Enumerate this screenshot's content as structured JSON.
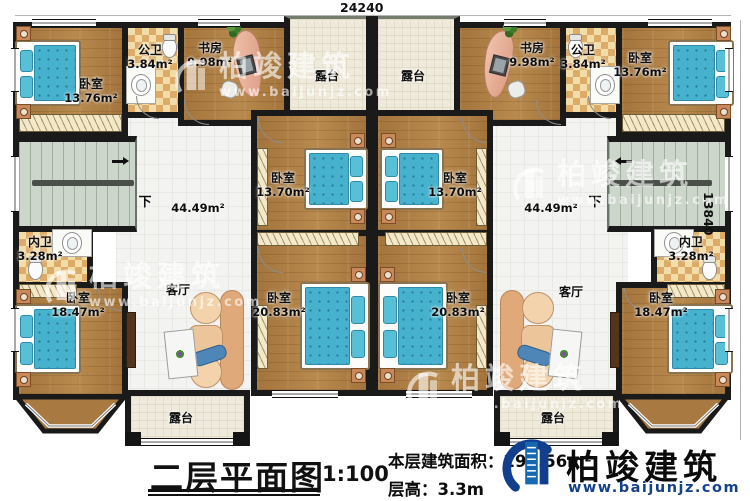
{
  "dimensions": {
    "top": "24240",
    "right": "13840"
  },
  "watermark": {
    "text": "柏竣建筑",
    "website": "www.baijunjz.com"
  },
  "rooms": {
    "bedroom_top_left": {
      "name": "卧室",
      "area": "13.76m²"
    },
    "public_bath_left": {
      "name": "公卫",
      "area": "3.84m²"
    },
    "study_left": {
      "name": "书房",
      "area": "9.98m²"
    },
    "terrace_top_left": {
      "name": "露台"
    },
    "terrace_top_right": {
      "name": "露台"
    },
    "study_right": {
      "name": "书房",
      "area": "9.98m²"
    },
    "public_bath_right": {
      "name": "公卫",
      "area": "3.84m²"
    },
    "bedroom_top_right": {
      "name": "卧室",
      "area": "13.76m²"
    },
    "hall_left": {
      "area": "44.49m²",
      "down_label": "下"
    },
    "hall_right": {
      "area": "44.49m²",
      "down_label": "下"
    },
    "bedroom_mid_left": {
      "name": "卧室",
      "area": "13.70m²"
    },
    "bedroom_mid_right": {
      "name": "卧室",
      "area": "13.70m²"
    },
    "inner_bath_left": {
      "name": "内卫",
      "area": "3.28m²"
    },
    "inner_bath_right": {
      "name": "内卫",
      "area": "3.28m²"
    },
    "bedroom_bottom_left": {
      "name": "卧室",
      "area": "18.47m²"
    },
    "bedroom_bottom_right": {
      "name": "卧室",
      "area": "18.47m²"
    },
    "living_left": {
      "name": "客厅"
    },
    "living_right": {
      "name": "客厅"
    },
    "bedroom_bottom_center_left": {
      "name": "卧室",
      "area": "20.83m²"
    },
    "bedroom_bottom_center_right": {
      "name": "卧室",
      "area": "20.83m²"
    },
    "terrace_bottom_left": {
      "name": "露台"
    },
    "terrace_bottom_right": {
      "name": "露台"
    }
  },
  "footer": {
    "title": "二层平面图",
    "scale": "1:100",
    "floor_area_label": "本层建筑面积：",
    "floor_area_value": "297.56m²",
    "floor_height_label": "层高：",
    "floor_height_value": "3.3m"
  },
  "branding": {
    "name": "柏竣建筑",
    "website": "www.baijunjz.com",
    "color_blue": "#1668b0",
    "color_navy": "#123f8c"
  }
}
